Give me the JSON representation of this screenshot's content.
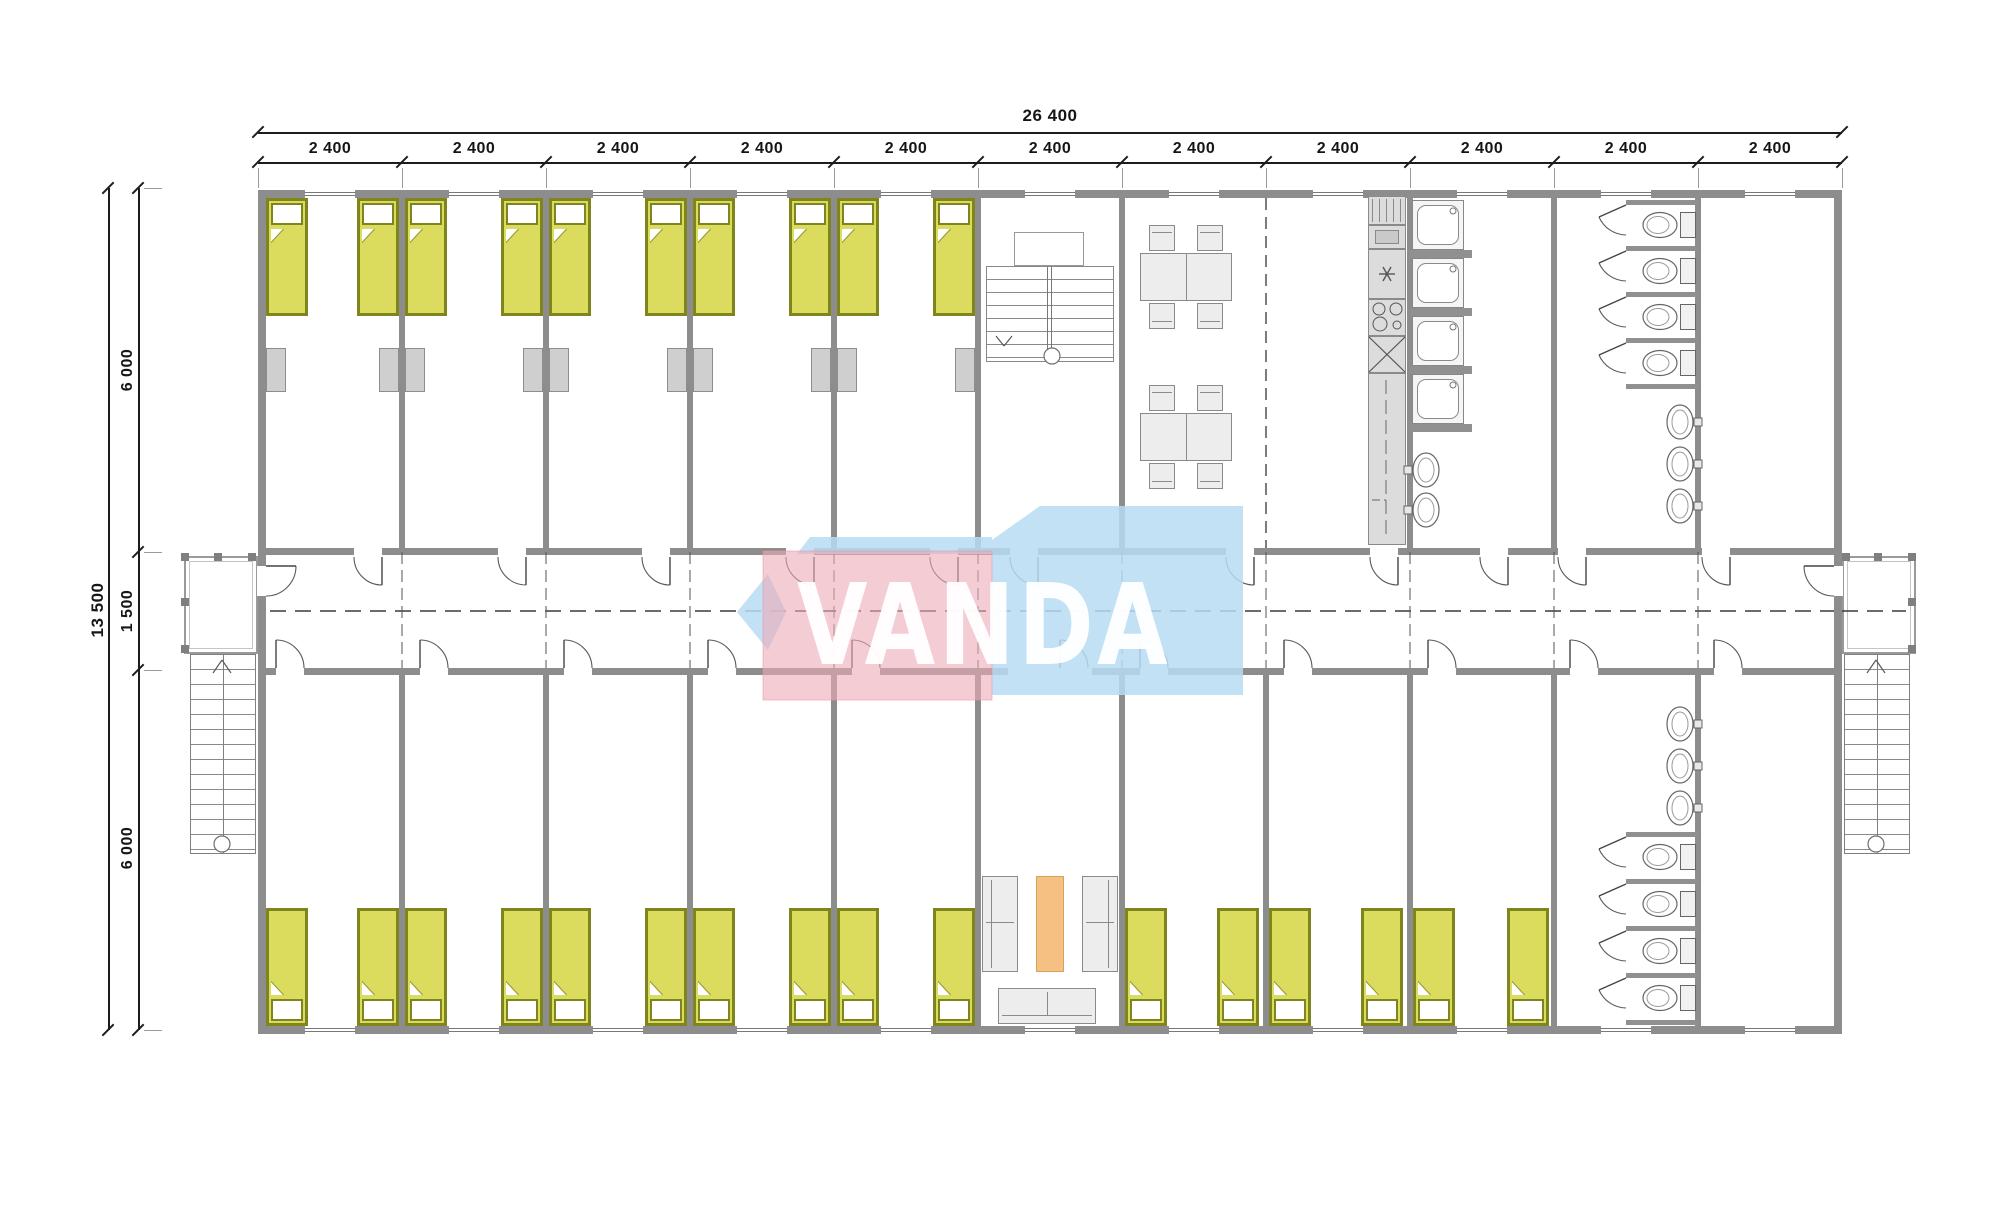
{
  "title": "Modular dormitory floor plan",
  "watermark": {
    "text": "VANDA",
    "blue": "#b7dcf2",
    "pink": "#edaab8",
    "text_color": "#ffffff"
  },
  "dimensions": {
    "total_width_label": "26 400",
    "bay_width_label": "2 400",
    "bay_count": 11,
    "total_height_label": "13 500",
    "upper_zone_label": "6 000",
    "corridor_label": "1 500",
    "lower_zone_label": "6 000"
  },
  "contents_summary": {
    "bedrooms": 13,
    "beds": 26,
    "wardrobes": 10,
    "dining_tables": 2,
    "dining_chairs": 8,
    "kitchen_units": [
      "fridge",
      "cabinet",
      "worktop",
      "stove-4-burners",
      "sink",
      "counter"
    ],
    "showers": 4,
    "toilets": 8,
    "washbasins": 8,
    "sofas": 3,
    "coffee_tables": 1,
    "stairs": {
      "internal": 1,
      "external": 2,
      "porches": 2
    },
    "corridor_centerline": true
  },
  "plan": {
    "colors": {
      "wall": "#8d8d8d",
      "wall_line": "#6e6e6e",
      "bed_fill": "#dbdb5e",
      "bed_frame": "#7f851d",
      "furniture_fill": "#ededed",
      "furniture_line": "#8a8a8a",
      "wardrobe": "#cfcfcf",
      "table_orange": "#f7c083",
      "table_orange_line": "#d6a15e",
      "dim": "#1c1c1c",
      "arc": "#5a5a5a"
    },
    "walls": [
      [
        258,
        190,
        1584,
        8
      ],
      [
        258,
        1026,
        1584,
        8
      ],
      [
        258,
        190,
        8,
        844
      ],
      [
        1834,
        190,
        8,
        844
      ],
      [
        266,
        548,
        1568,
        7
      ],
      [
        266,
        668,
        1568,
        7
      ],
      [
        399,
        198,
        6,
        350
      ],
      [
        543,
        198,
        6,
        350
      ],
      [
        687,
        198,
        6,
        350
      ],
      [
        831,
        198,
        6,
        350
      ],
      [
        975,
        198,
        6,
        350
      ],
      [
        1119,
        198,
        6,
        350
      ],
      [
        1407,
        198,
        6,
        350
      ],
      [
        1551,
        198,
        6,
        350
      ],
      [
        1695,
        198,
        6,
        350
      ],
      [
        399,
        675,
        6,
        351
      ],
      [
        543,
        675,
        6,
        351
      ],
      [
        687,
        675,
        6,
        351
      ],
      [
        831,
        675,
        6,
        351
      ],
      [
        975,
        675,
        6,
        351
      ],
      [
        1119,
        675,
        6,
        351
      ],
      [
        1263,
        675,
        6,
        351
      ],
      [
        1407,
        675,
        6,
        351
      ],
      [
        1551,
        675,
        6,
        351
      ],
      [
        1695,
        675,
        6,
        351
      ]
    ],
    "dashed_wall": {
      "x": 1266,
      "y1": 198,
      "y2": 548
    },
    "axes": {
      "xs": [
        402,
        546,
        690,
        834,
        978,
        1122,
        1266,
        1410,
        1554,
        1698
      ],
      "y1": 552,
      "y2": 668
    },
    "centerline": {
      "y": 611,
      "x1": 270,
      "x2": 1834,
      "ext_x1": 1842,
      "ext_x2": 1906
    },
    "windows": {
      "w": 50,
      "cxs": [
        330,
        474,
        618,
        762,
        906,
        1050,
        1194,
        1338,
        1482,
        1626,
        1770
      ],
      "top_y": 190,
      "bottom_y": 1026
    },
    "doors": {
      "w": 28,
      "top_xs": [
        354,
        498,
        642,
        786,
        930,
        1010,
        1226,
        1370,
        1480,
        1558,
        1702
      ],
      "bottom_xs": [
        276,
        420,
        564,
        708,
        852,
        1140,
        1284,
        1428,
        1570,
        1714
      ],
      "lounge_opening": {
        "x": 1008,
        "w": 84,
        "door_x": 1060
      },
      "ends": [
        {
          "x": 257,
          "y": 566
        },
        {
          "x": 1833,
          "y": 566
        }
      ]
    },
    "beds": {
      "w": 42,
      "h": 118,
      "top": {
        "y": 198,
        "pillow": "top",
        "xs": [
          266,
          357,
          405,
          501,
          549,
          645,
          693,
          789,
          837,
          933
        ]
      },
      "bottom": {
        "y": 908,
        "pillow": "bottom",
        "xs": [
          266,
          357,
          405,
          501,
          549,
          645,
          693,
          789,
          837,
          933,
          1125,
          1217,
          1269,
          1361,
          1413,
          1507
        ]
      }
    },
    "wardrobes": {
      "y": 348,
      "w": 20,
      "h": 44,
      "xs": [
        266,
        379,
        405,
        523,
        549,
        667,
        693,
        811,
        837,
        955
      ]
    },
    "stair_internal": {
      "landing": [
        1014,
        232,
        70,
        34
      ],
      "flight": [
        986,
        266,
        128,
        96
      ],
      "rails": [
        60,
        64
      ],
      "arrow": [
        1004,
        346
      ],
      "circle": [
        1052,
        356
      ]
    },
    "stairs_external": [
      {
        "porch": [
          184,
          556,
          74,
          98
        ],
        "flight": [
          190,
          654,
          66,
          200
        ],
        "center": 222,
        "arrow": [
          222,
          660
        ],
        "circle": [
          222,
          844
        ],
        "posts": [
          [
            181,
            553
          ],
          [
            181,
            598
          ],
          [
            181,
            645
          ],
          [
            214,
            553
          ],
          [
            248,
            553
          ]
        ]
      },
      {
        "porch": [
          1842,
          556,
          74,
          98
        ],
        "flight": [
          1844,
          654,
          66,
          200
        ],
        "center": 1876,
        "arrow": [
          1876,
          660
        ],
        "circle": [
          1876,
          844
        ],
        "posts": [
          [
            1908,
            553
          ],
          [
            1908,
            598
          ],
          [
            1908,
            645
          ],
          [
            1874,
            553
          ],
          [
            1842,
            553
          ]
        ]
      }
    ],
    "dining": {
      "table_x": 1140,
      "table_w": 92,
      "table_h": 48,
      "table_ys": [
        253,
        413
      ],
      "chair_w": 26,
      "chair_h": 26,
      "chair_xs": [
        1149,
        1197
      ]
    },
    "kitchen": {
      "x": 1368,
      "w": 38,
      "units": [
        [
          "fridge",
          196,
          29
        ],
        [
          "cabinet",
          225,
          24
        ],
        [
          "worktop",
          249,
          50
        ],
        [
          "stove",
          299,
          37
        ],
        [
          "sink",
          336,
          37
        ],
        [
          "counter",
          373,
          172
        ]
      ]
    },
    "showers": {
      "x": 1412,
      "w": 52,
      "h": 50,
      "ys": [
        200,
        258,
        316,
        374
      ],
      "divider_ys": [
        250,
        308,
        366,
        424
      ],
      "basin_cys": [
        470,
        510
      ],
      "basin_cx": 1426
    },
    "toilet_rooms": [
      {
        "divider_ys": [
          200,
          246,
          292,
          338,
          384
        ],
        "toilet_cys": [
          225,
          271,
          317,
          363
        ],
        "basin_cys": [
          422,
          464,
          506
        ],
        "door_sys": [
          205,
          251,
          297,
          343
        ]
      },
      {
        "divider_ys": [
          832,
          879,
          926,
          973,
          1020
        ],
        "toilet_cys": [
          857,
          904,
          951,
          998
        ],
        "basin_cys": [
          724,
          766,
          808
        ],
        "door_sys": [
          837,
          884,
          931,
          978
        ]
      }
    ],
    "stall": {
      "x": 1626,
      "w": 72,
      "t": 5,
      "tank_x": 1680,
      "bowl_cx": 1660,
      "basin_cx": 1680
    },
    "lounge": {
      "sofa_l": [
        982,
        876,
        36,
        96
      ],
      "sofa_r": [
        1082,
        876,
        36,
        96
      ],
      "table": [
        1036,
        876,
        28,
        96
      ],
      "sofa_b": [
        998,
        988,
        98,
        36
      ]
    },
    "dim_geom": {
      "x1": 258,
      "x2": 1842,
      "bay": 144,
      "top_line1_y": 132,
      "top_line2_y": 162,
      "left_line1_x": 108,
      "left_line2_x": 138,
      "y1": 188,
      "y2": 1030,
      "zone_ticks": [
        188,
        552,
        670,
        1030
      ]
    }
  }
}
